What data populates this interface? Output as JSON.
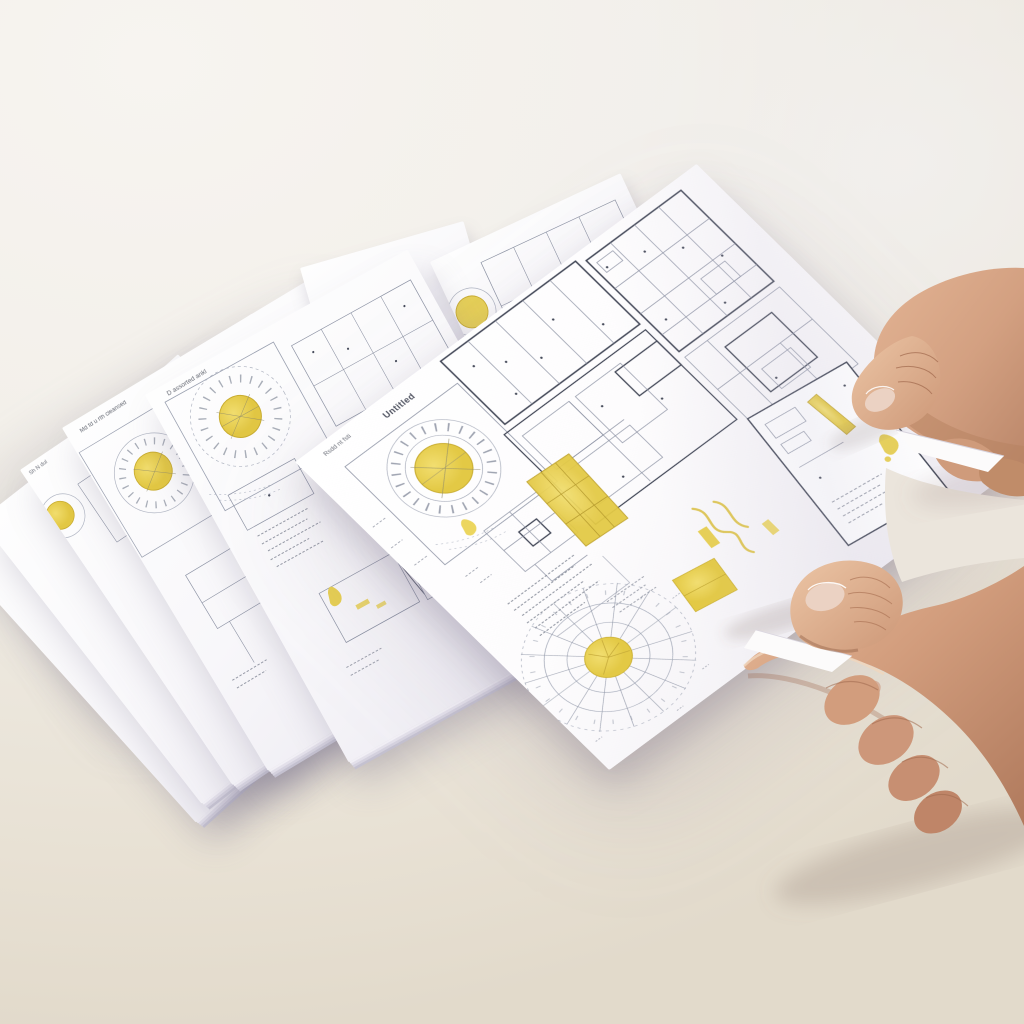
{
  "scene": {
    "type": "photograph",
    "description": "Two hands holding a printed architectural drawing sheet with yellow sun-study highlights above a fanned stack of similar drawing sheets on a white tabletop"
  },
  "palette": {
    "paper": "#fdfdfe",
    "paper_shade": "#e4e1ea",
    "paper_edge": "#c6c3d2",
    "accent": "#e8d150",
    "accent_deep": "#c9ad31",
    "ink": "#3f4454",
    "ink_thin": "#8d93a4",
    "ink_faint": "#b2b7c4",
    "table_light": "#f4f1ec",
    "table_dark": "#e3dbcc",
    "skin": "#d7a487",
    "skin_light": "#eed2ba",
    "skin_dark": "#a96f53",
    "skin_deep": "#7e4c38",
    "nail": "#ebd2c3"
  },
  "held_sheet": {
    "title_left": "Rsdd nt fsti",
    "title_main": "Untitled",
    "caption_titleblock": "Jsed annmankintl"
  },
  "stack": {
    "sheet1_title": "D assorted ankl",
    "sheet2_title": "Md fd u rth cleansed",
    "sheet3_title": "Sh N dul"
  }
}
